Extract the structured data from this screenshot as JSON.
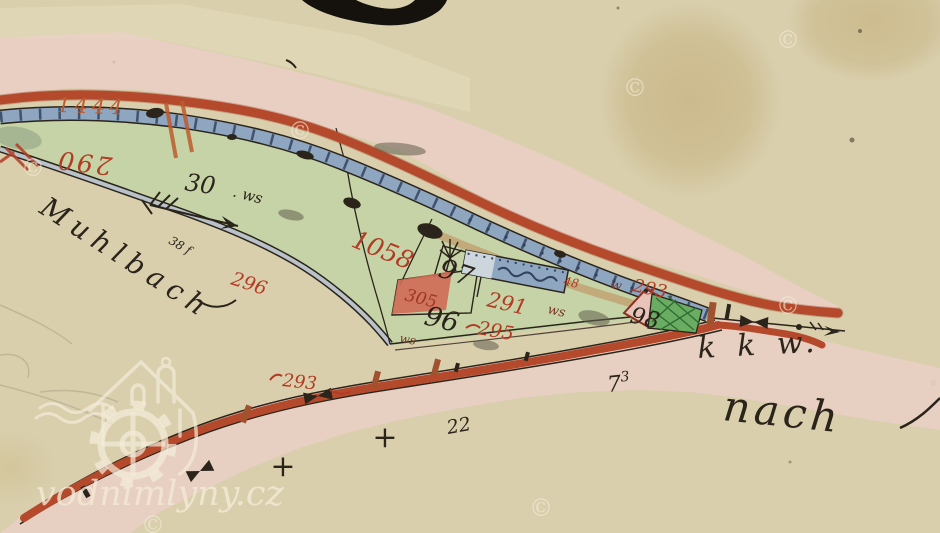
{
  "palette": {
    "paper": "#d9cfad",
    "paper_light": "#e6ddbd",
    "stain": "#b89d5f",
    "pink": "#eccfc9",
    "road_red": "#b5492c",
    "road_deep": "#8f3a20",
    "race_blue": "#8ea6c0",
    "race_light": "#ccd6dc",
    "race_dark": "#32435f",
    "stream_fill": "#b9c2c8",
    "meadow": "#c5d3a6",
    "meadow_dark": "#9aa98a",
    "garden": "#6aad62",
    "garden_dark": "#2e6e34",
    "bank_tan": "#c2a070",
    "ink": "#2b241a",
    "label_red": "#b23b24",
    "label_orange": "#bd5c2e",
    "building_red": "#cf6a55",
    "diamond_fill": "#e7c3ba",
    "watermark": "#f4ecd8",
    "pencil": "#6a6152",
    "smudge": "#63604f"
  },
  "watermark": {
    "site": "vodnimlyny.cz",
    "copyright": "©"
  },
  "map": {
    "labels": {
      "stream_name": "Muhlbach",
      "direction_note": "nach",
      "road_abbr": "k k w.",
      "parcel_1444": "1444",
      "parcel_290": "290",
      "parcel_30": "30",
      "parcel_30_suffix": ". ws",
      "arrow_note": "38 f",
      "parcel_296": "296",
      "parcel_1058": "1058",
      "parcel_97": "97",
      "parcel_96": "96",
      "parcel_305": "305",
      "parcel_291": "291",
      "ws_abbr": "ws",
      "w_abbr": "w",
      "parcel_295": "295",
      "parcel_48": "48",
      "parcel_293_upper": "293",
      "parcel_98": "98",
      "parcel_293_lower": "293",
      "distance_73_main": "7",
      "distance_73_sup": "3",
      "distance_22": "22",
      "plus_mark": "+"
    }
  }
}
